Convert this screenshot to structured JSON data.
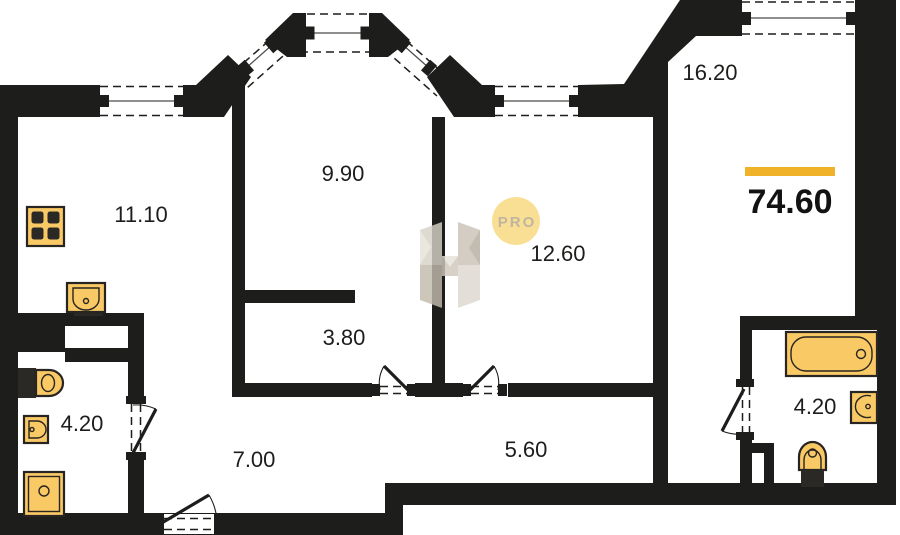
{
  "plan": {
    "title": "apartment-floor-plan",
    "total_area": {
      "value": "74.60",
      "accent_color": "#f0b228"
    },
    "watermark": {
      "badge_text": "PRO",
      "letter": "H",
      "badge_fill": "#f8d87d",
      "badge_text_color": "#b3a78c"
    },
    "rooms": [
      {
        "name": "kitchen",
        "area_label": "11.10"
      },
      {
        "name": "room-bay",
        "area_label": "9.90"
      },
      {
        "name": "room-middle",
        "area_label": "12.60"
      },
      {
        "name": "room-right",
        "area_label": "16.20"
      },
      {
        "name": "corridor-nook",
        "area_label": "3.80"
      },
      {
        "name": "bathroom-left",
        "area_label": "4.20"
      },
      {
        "name": "hallway-left",
        "area_label": "7.00"
      },
      {
        "name": "hallway-right",
        "area_label": "5.60"
      },
      {
        "name": "bathroom-right",
        "area_label": "4.20"
      }
    ],
    "icons": [
      "stove-icon",
      "kitchen-sink-icon",
      "wall-hung-toilet-icon",
      "washbasin-small-icon",
      "washing-machine-icon",
      "bathtub-icon",
      "washbasin-right-icon",
      "toilet-right-icon"
    ],
    "colors": {
      "wall": "#1d1d1b",
      "fixture_fill": "#f9c966",
      "fixture_stroke": "#272421",
      "accent": "#f0b228",
      "background": "#ffffff"
    }
  }
}
